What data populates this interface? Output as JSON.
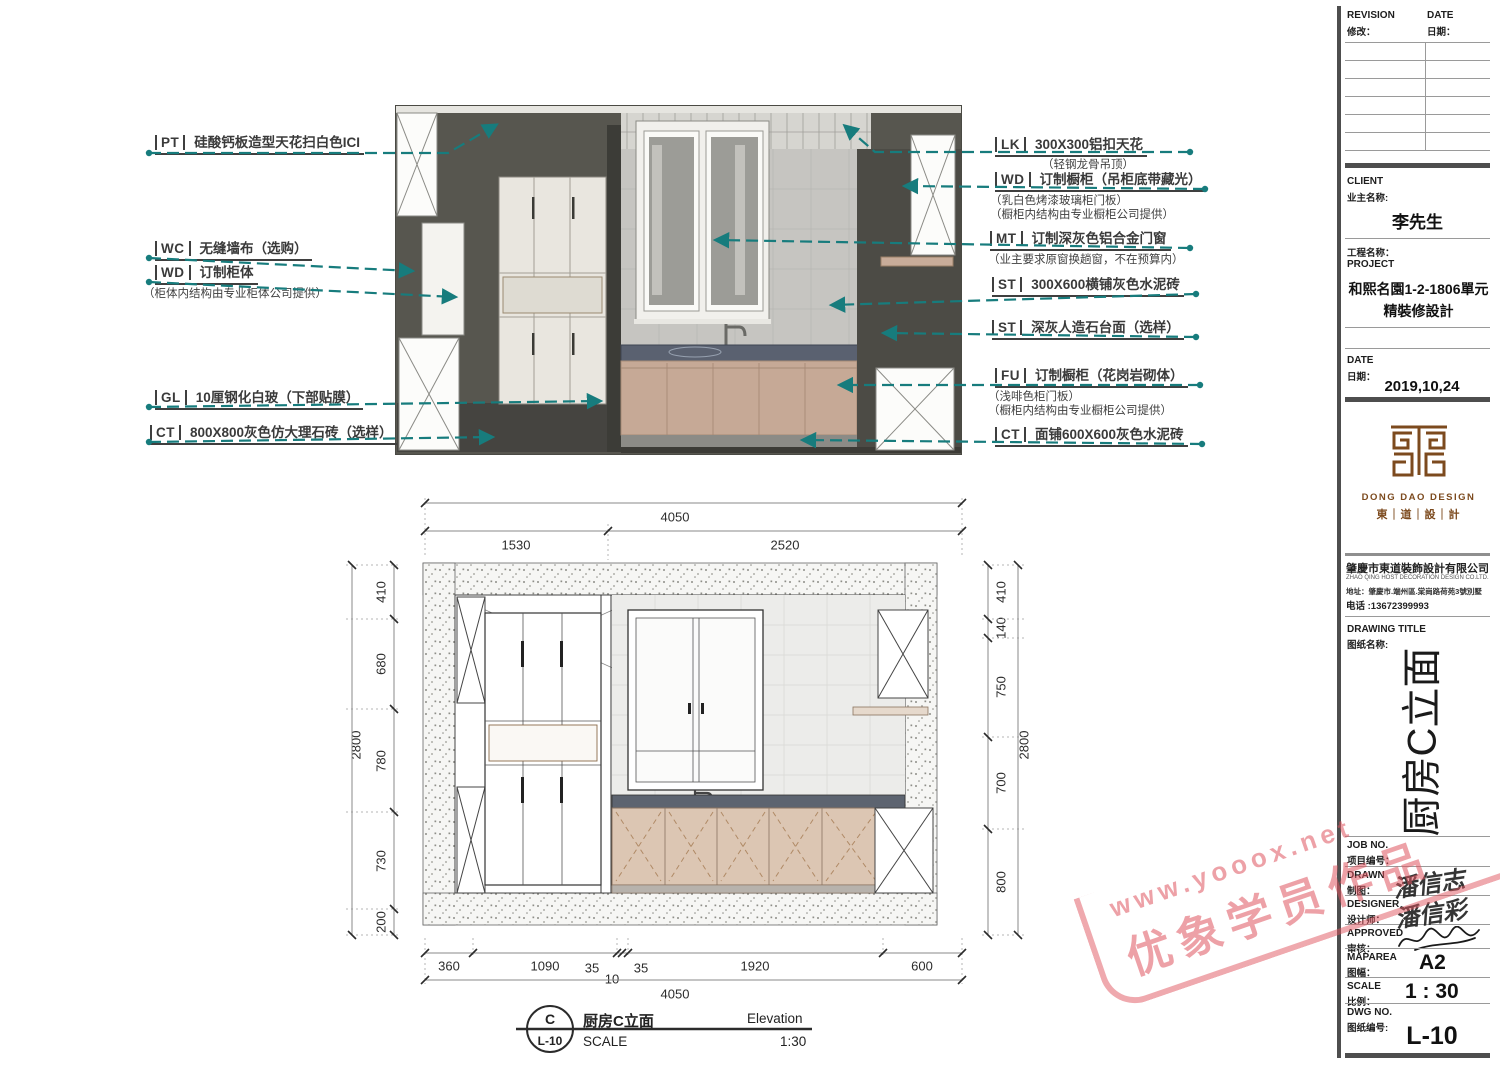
{
  "colors": {
    "leader_teal": "#177c7d",
    "watermark_red": "#e26069",
    "logo_brown": "#7c4a1e",
    "counter_dark": "#5a6170",
    "cabinet_tan": "#c6a996",
    "wall_dark": "#57564f",
    "tile_gray": "#c6c5c1"
  },
  "annotations": {
    "left": [
      {
        "code": "PT",
        "text": "硅酸钙板造型天花扫白色ICI",
        "notes": []
      },
      {
        "code": "WC",
        "text": "无缝墙布（选购）",
        "notes": []
      },
      {
        "code": "WD",
        "text": "订制柜体",
        "notes": [
          "（柜体内结构由专业柜体公司提供）"
        ]
      },
      {
        "code": "GL",
        "text": "10厘钢化白玻（下部贴膜）",
        "notes": []
      },
      {
        "code": "CT",
        "text": "800X800灰色仿大理石砖（选样）",
        "notes": []
      }
    ],
    "right": [
      {
        "code": "LK",
        "text": "300X300铝扣天花",
        "notes": [
          "（轻钢龙骨吊顶）"
        ]
      },
      {
        "code": "WD",
        "text": "订制橱柜（吊柜底带藏光）",
        "notes": [
          "（乳白色烤漆玻璃柜门板）",
          "（橱柜内结构由专业橱柜公司提供）"
        ]
      },
      {
        "code": "MT",
        "text": "订制深灰色铝合金门窗",
        "notes": [
          "（业主要求原窗换趟窗，不在预算内）"
        ]
      },
      {
        "code": "ST",
        "text": "300X600横铺灰色水泥砖",
        "notes": []
      },
      {
        "code": "ST",
        "text": "深灰人造石台面（选样）",
        "notes": []
      },
      {
        "code": "FU",
        "text": "订制橱柜（花岗岩砌体）",
        "notes": [
          "（浅啡色柜门板）",
          "（橱柜内结构由专业橱柜公司提供）"
        ]
      },
      {
        "code": "CT",
        "text": "面铺600X600灰色水泥砖",
        "notes": []
      }
    ]
  },
  "dims": {
    "top_overall": "4050",
    "top_segments": [
      "1530",
      "2520"
    ],
    "left_overall": "2800",
    "left_segments": [
      "410",
      "680",
      "780",
      "730",
      "200"
    ],
    "right_overall": "2800",
    "right_segments": [
      "410",
      "140",
      "750",
      "700",
      "800"
    ],
    "bottom_overall": "4050",
    "bottom_segments": [
      "360",
      "1090",
      "35",
      "10",
      "35",
      "1920",
      "600"
    ]
  },
  "view_title": {
    "bubble_top": "C",
    "bubble_bottom": "L-10",
    "title_cn": "厨房C立面",
    "title_en": "Elevation",
    "scale_label": "SCALE",
    "scale_value": "1:30"
  },
  "titleblock": {
    "revision": {
      "en": "REVISION",
      "cn": "修改："
    },
    "revision_date": {
      "en": "DATE",
      "cn": "日期："
    },
    "client": {
      "en": "CLIENT",
      "cn": "业主名称:",
      "value": "李先生"
    },
    "project": {
      "cn": "工程名称：",
      "en": "PROJECT",
      "value1": "和熙名園1-2-1806單元",
      "value2": "精裝修設計"
    },
    "date": {
      "en": "DATE",
      "cn": "日期：",
      "value": "2019,10,24"
    },
    "logo": {
      "en": "DONG DAO DESIGN",
      "cn": "東｜道｜設｜計"
    },
    "company": {
      "name": "肇慶市東道裝飾設計有限公司",
      "name_en": "ZHAO QING HOST DECORATION DESIGN CO.LTD.",
      "address": "地址：肇慶市.端州區.棠崗路荷苑3號別墅",
      "phone": "电话 :13672399993"
    },
    "drawing_title": {
      "en": "DRAWING TITLE",
      "cn": "图纸名称:",
      "value": "厨房C立面"
    },
    "job_no": {
      "en": "JOB NO.",
      "cn": "项目编号："
    },
    "drawn": {
      "en": "DRAWN",
      "cn": "制图："
    },
    "designer": {
      "en": "DESIGNER",
      "cn": "设计师："
    },
    "approved": {
      "en": "APPROVED",
      "cn": "审核："
    },
    "signatures": {
      "drawn": "潘信志",
      "designer": "潘信彩"
    },
    "maparea": {
      "en": "MAPAREA",
      "cn": "图幅：",
      "value": "A2"
    },
    "scale": {
      "en": "SCALE",
      "cn": "比例：",
      "value": "1 : 30"
    },
    "dwg_no": {
      "en": "DWG NO.",
      "cn": "图纸编号:",
      "value": "L-10"
    }
  },
  "watermark": {
    "line1": "www.yooox.net",
    "line2": "优象学员作品"
  }
}
